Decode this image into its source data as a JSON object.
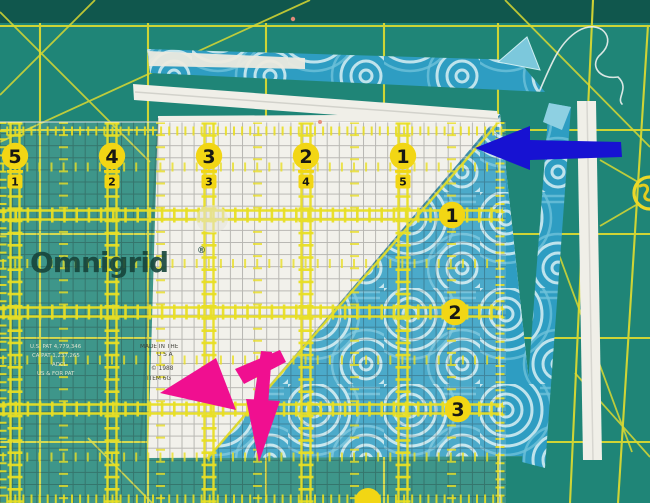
{
  "ruler": {
    "brand": "Omnigrid",
    "trademark": "®",
    "top_scale": [
      {
        "major": "5",
        "minor": "1"
      },
      {
        "major": "4",
        "minor": "2"
      },
      {
        "major": "3",
        "minor": "3"
      },
      {
        "major": "2",
        "minor": "4"
      },
      {
        "major": "1",
        "minor": "5"
      }
    ],
    "right_scale": [
      "1",
      "2",
      "3"
    ],
    "patent_text": [
      "U.S. PAT 4,779,346",
      "CA PAT 1,237,265",
      "ADCL",
      "US & FOR PAT"
    ],
    "origin_text": [
      "MADE IN THE",
      "U S A",
      "© 1988",
      "ITEM 6G"
    ],
    "colors": {
      "marking_yellow": "#e8de24",
      "badge_yellow": "#f2d614",
      "digit_black": "#181814",
      "logo_green": "#17453b"
    }
  },
  "mat": {
    "surface": "#1f8577",
    "top_band": "#10574d",
    "grid_line": "#d9d831"
  },
  "fabrics": {
    "white": "#f0efe8",
    "teal": "#2e9dc2",
    "print_line": "#d9f0f4"
  },
  "annotations": {
    "blue_arrow": "#1712d2",
    "pink_arrow": "#f00f90"
  }
}
